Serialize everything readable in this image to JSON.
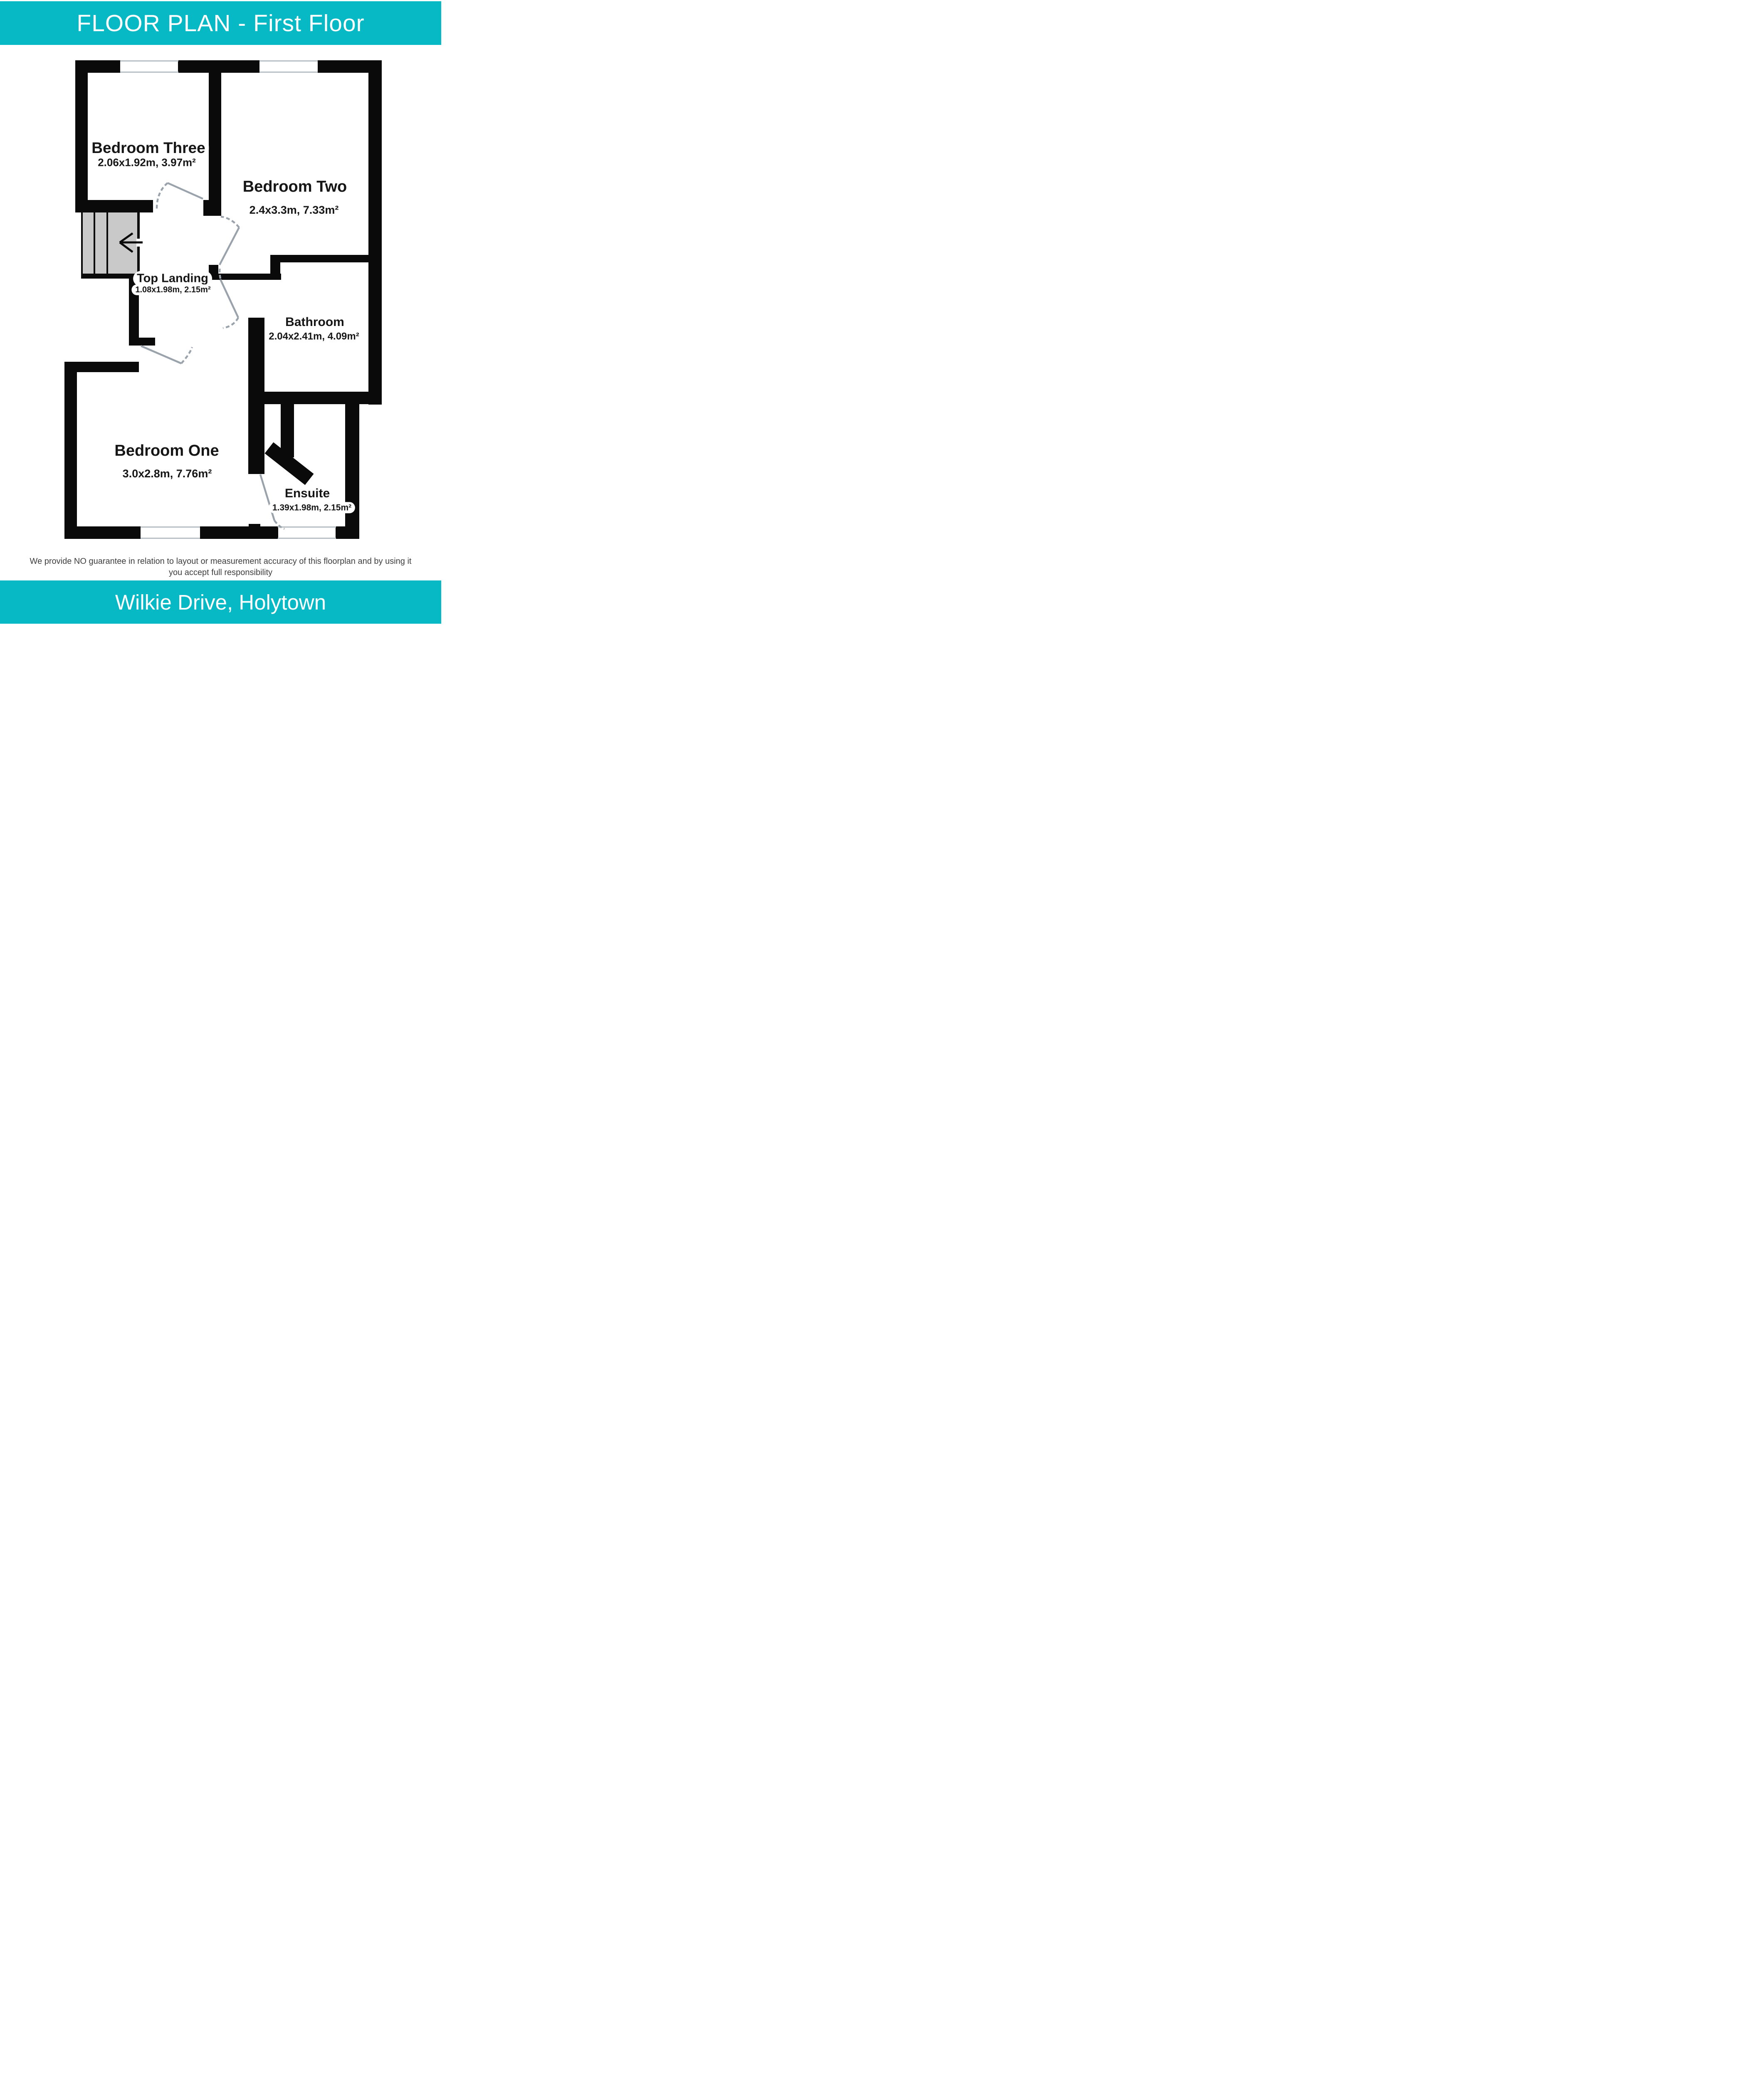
{
  "header": {
    "title": "FLOOR PLAN - First Floor"
  },
  "footer": {
    "address": "Wilkie Drive, Holytown"
  },
  "disclaimer": {
    "line1": "We provide NO guarantee in relation to layout or measurement accuracy of this floorplan and by using it",
    "line2": "you accept full responsibility"
  },
  "rooms": {
    "bedroom_three": {
      "name": "Bedroom Three",
      "dims": "2.06x1.92m, 3.97m²"
    },
    "bedroom_two": {
      "name": "Bedroom Two",
      "dims": "2.4x3.3m, 7.33m²"
    },
    "top_landing": {
      "name": "Top Landing",
      "dims": "1.08x1.98m, 2.15m²"
    },
    "bathroom": {
      "name": "Bathroom",
      "dims": "2.04x2.41m, 4.09m²"
    },
    "bedroom_one": {
      "name": "Bedroom One",
      "dims": "3.0x2.8m, 7.76m²"
    },
    "ensuite": {
      "name": "Ensuite",
      "dims": "1.39x1.98m, 2.15m²"
    }
  },
  "icons": {
    "stairs_arrow": "left-arrow"
  },
  "colors": {
    "accent_teal": "#07b9c4",
    "wall_black": "#0a0a0a",
    "stair_gray": "#c9c9c9",
    "door_gray": "#9aa3ab",
    "window_line_gray": "#b9c0c5",
    "disclaimer_gray": "#3d3d3d"
  }
}
